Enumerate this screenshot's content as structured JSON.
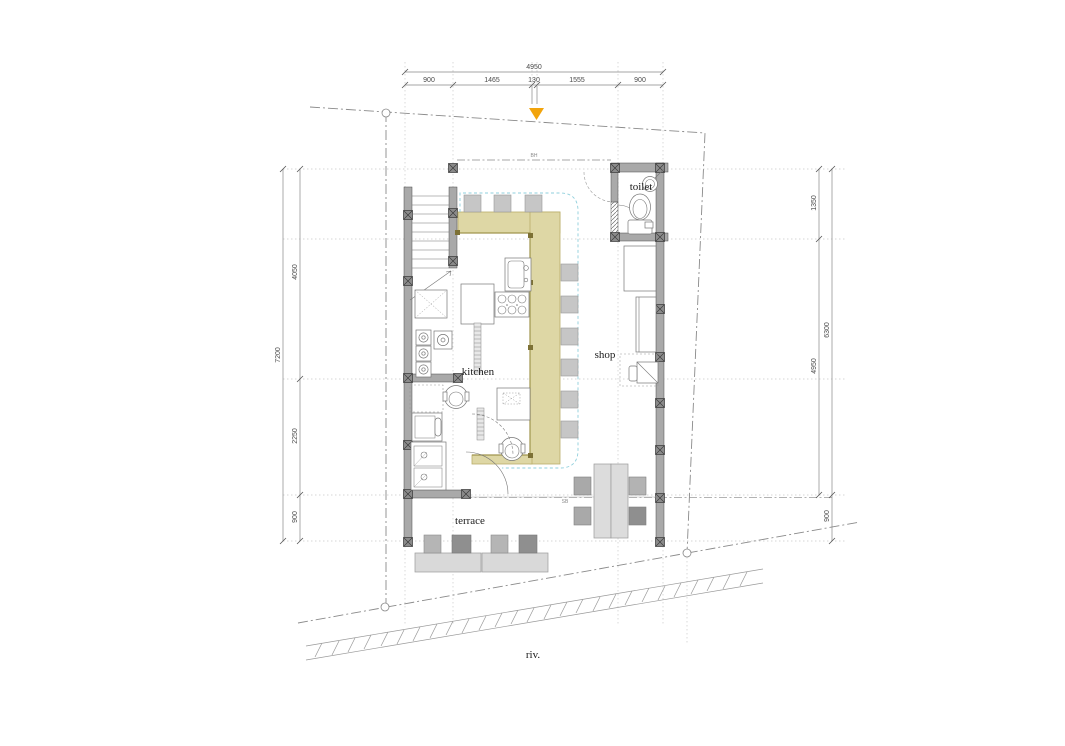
{
  "labels": {
    "kitchen": "kitchen",
    "shop": "shop",
    "toilet": "toilet",
    "terrace": "terrace",
    "river": "riv.",
    "bh": "BH",
    "sb": "SB"
  },
  "dimensions": {
    "top": {
      "total": "4950",
      "segments": [
        "900",
        "1465",
        "130",
        "1555",
        "900"
      ]
    },
    "left": {
      "total": "7200",
      "segments": [
        "4050",
        "2250",
        "900"
      ]
    },
    "right": {
      "overall": "6300",
      "segments": [
        "1350",
        "4950"
      ],
      "bottom": "900"
    }
  },
  "colors": {
    "counter": "#ded7a5",
    "counter_edge": "#a0954d",
    "counter_post": "#7d7135",
    "marker": "#f2a40c",
    "guide": "#8fcfdc"
  }
}
